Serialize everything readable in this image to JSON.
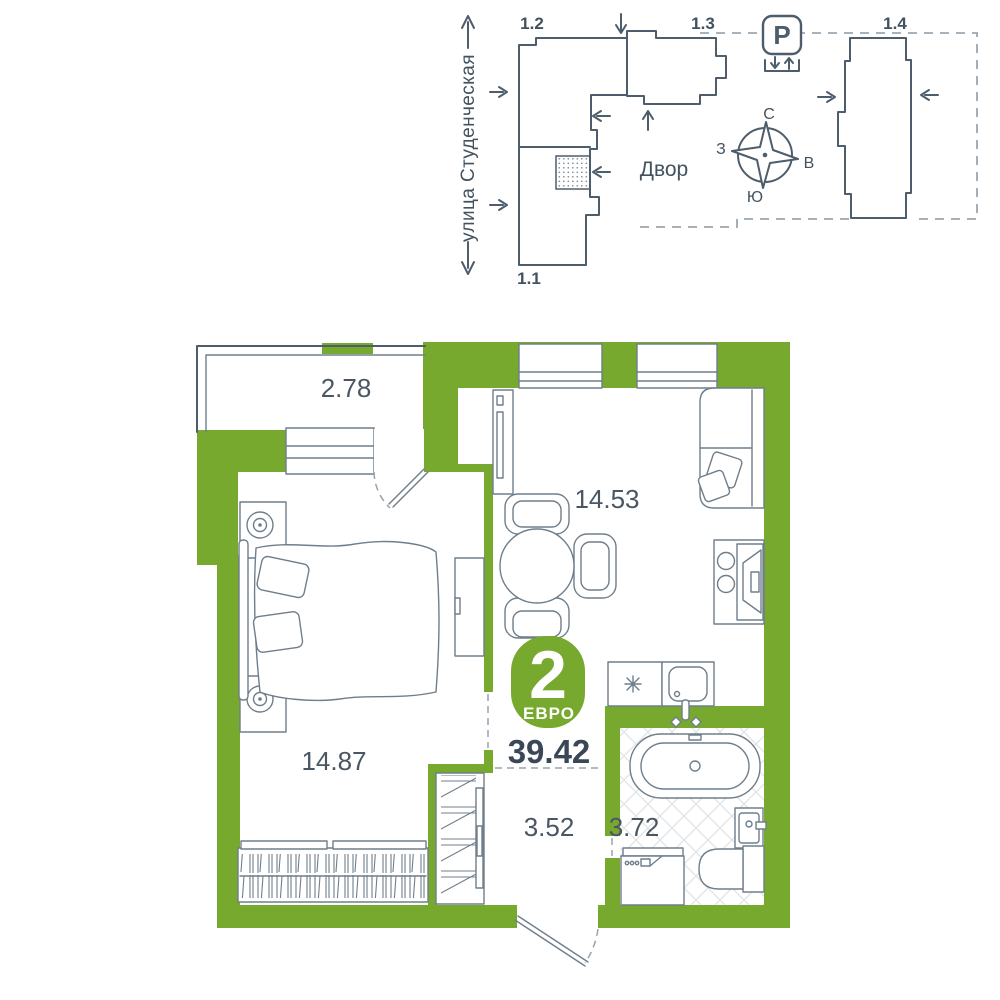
{
  "site_plan": {
    "street_label": "улица Студенческая",
    "courtyard_label": "Двор",
    "parking_icon": "P",
    "building_labels": [
      "1.2",
      "1.3",
      "1.1",
      "1.4"
    ],
    "compass": {
      "north": "С",
      "east": "В",
      "south": "Ю",
      "west": "З"
    }
  },
  "floor_plan": {
    "badge": {
      "rooms_count": "2",
      "type_label": "ЕВРО"
    },
    "total_area": "39.42",
    "rooms": [
      {
        "name": "balcony",
        "area": "2.78"
      },
      {
        "name": "kitchen-living-room",
        "area": "14.53"
      },
      {
        "name": "bedroom",
        "area": "14.87"
      },
      {
        "name": "hallway",
        "area": "3.52"
      },
      {
        "name": "bathroom",
        "area": "3.72"
      }
    ]
  },
  "colors": {
    "wall_green": "#77a92e",
    "site_lines": "#4e5d6b",
    "furniture_lines": "#6f7e8b",
    "text_dark": "#3a4757",
    "tile": "#dde2e6"
  }
}
